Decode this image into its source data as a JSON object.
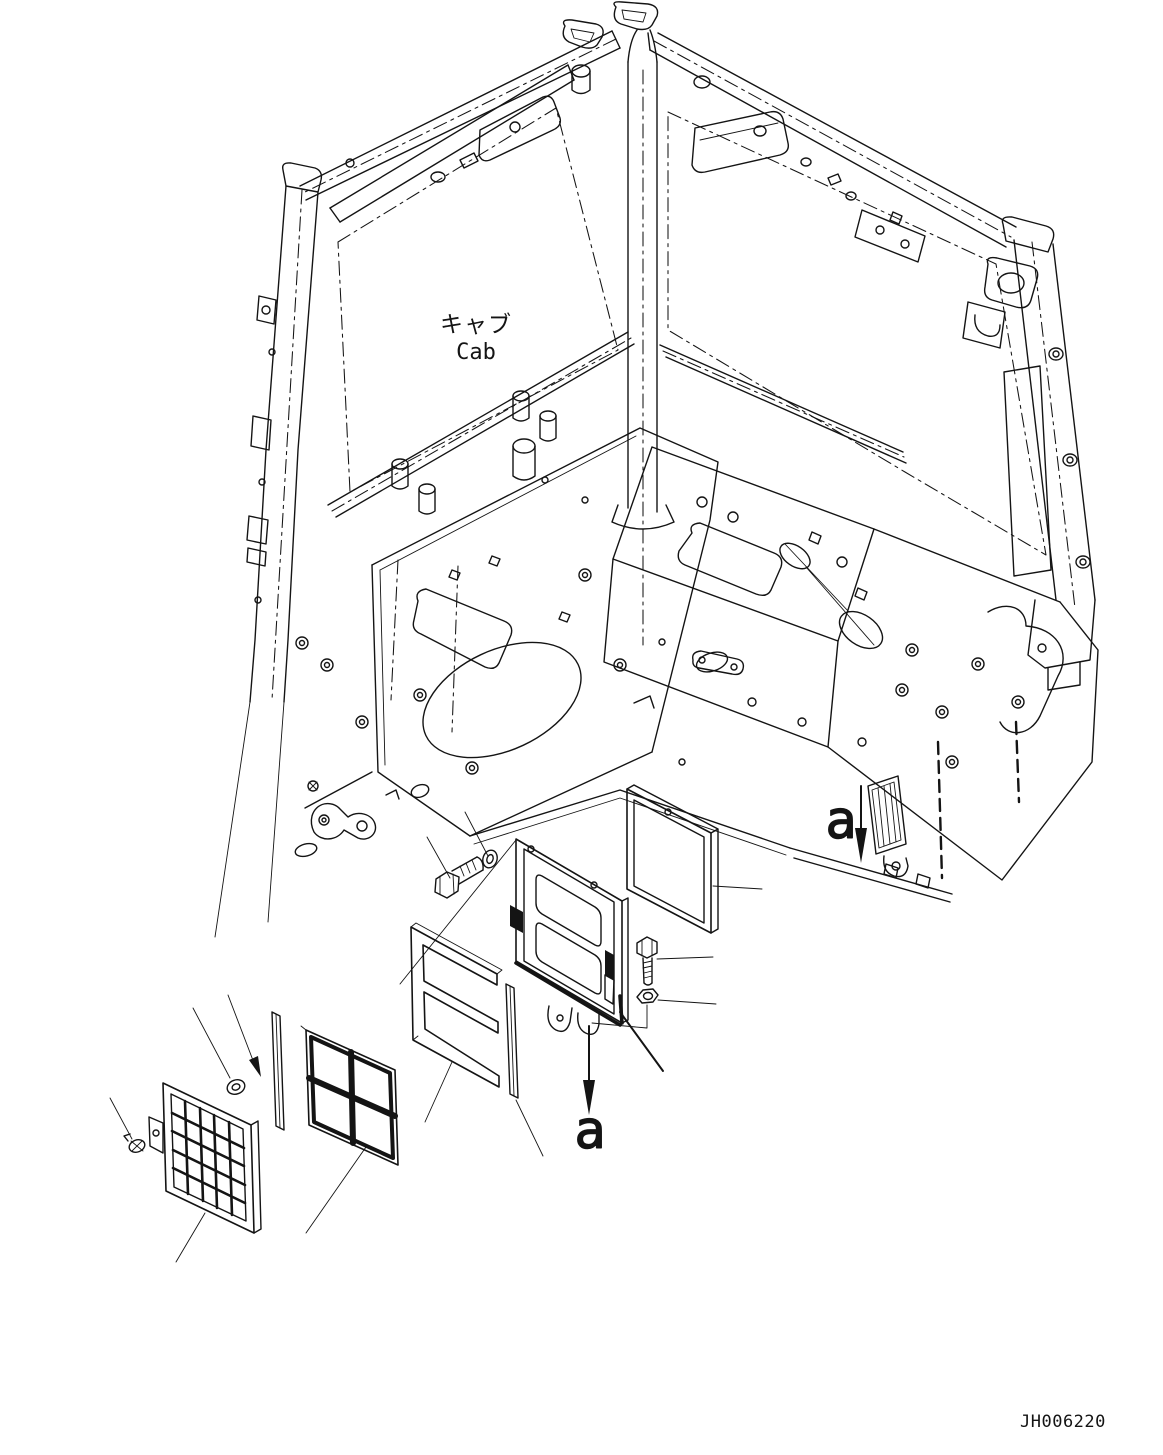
{
  "page": {
    "background": "#ffffff",
    "line_color": "#141414",
    "width_px": 1163,
    "height_px": 1455
  },
  "labels": {
    "cab_jp": "キャブ",
    "cab_en": "Cab",
    "section_marker_right": "a",
    "section_marker_bottom": "a",
    "drawing_number": "JH006220"
  }
}
